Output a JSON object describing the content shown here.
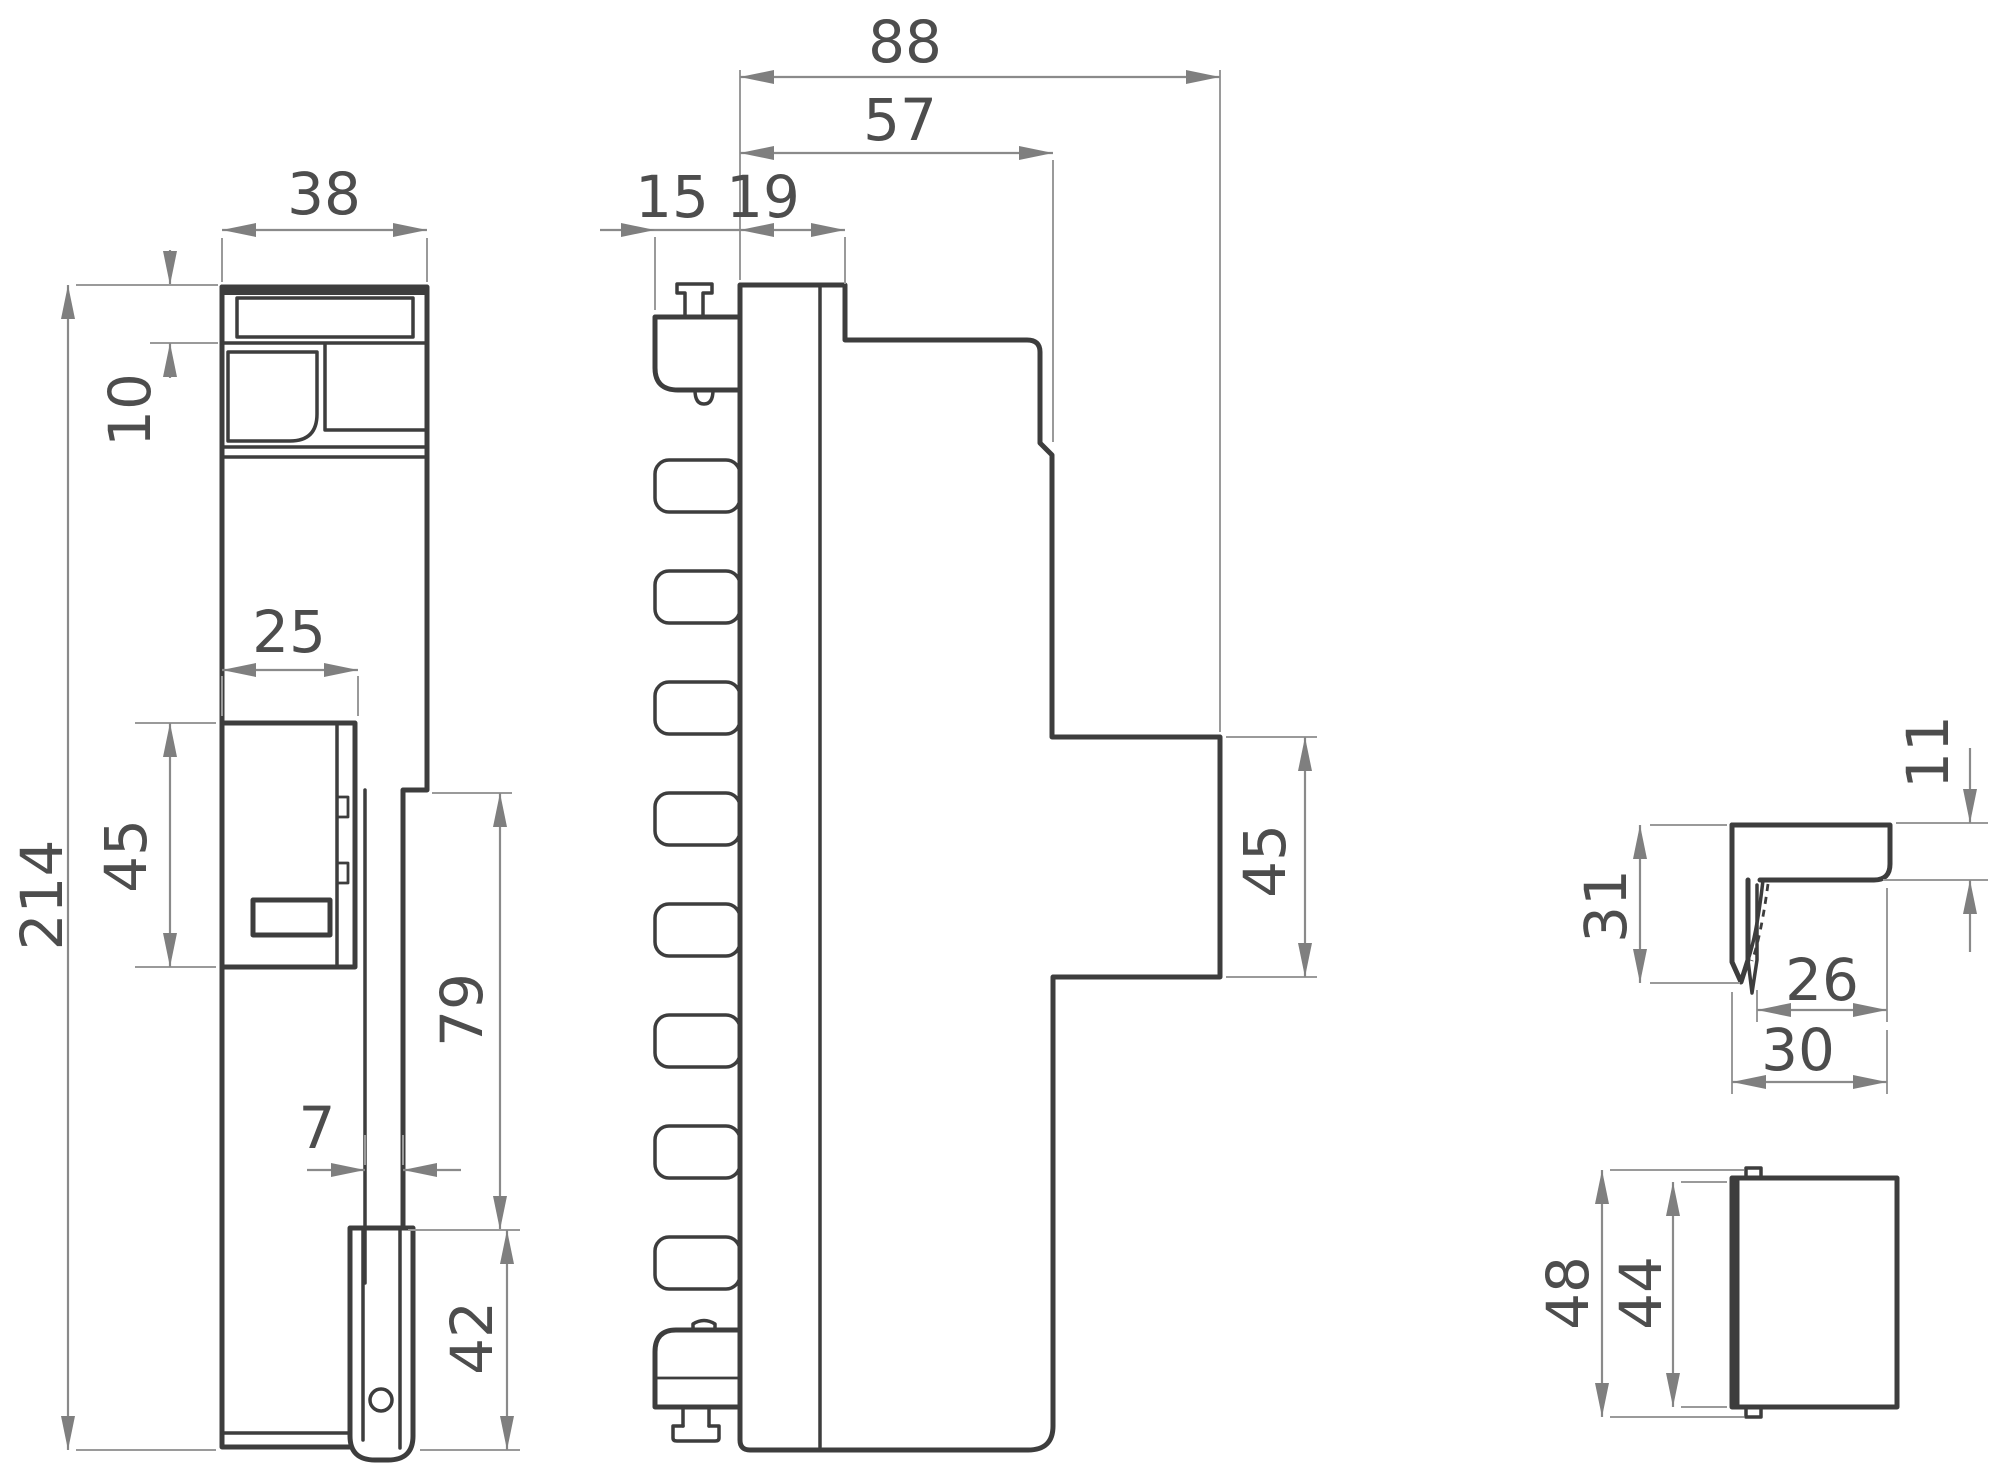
{
  "drawing_type": "technical-dimension-drawing",
  "views": {
    "front_view": "device front elevation",
    "side_view": "device side profile with fins",
    "bracket_view": "mounting bracket detail",
    "cover_view": "cover block detail"
  },
  "dims": {
    "front": {
      "overall_width": "38",
      "cap_height": "10",
      "overall_height": "214",
      "block_width": "25",
      "block_height": "45",
      "step_height": "79",
      "bar_width": "7",
      "latch_height": "42"
    },
    "side": {
      "overall_depth": "88",
      "body_depth": "57",
      "fin_depth": "15",
      "front_depth": "19",
      "tab_height": "45"
    },
    "bracket": {
      "lip_height": "11",
      "height": "31",
      "inner_width": "26",
      "width": "30"
    },
    "cover": {
      "outer_height": "48",
      "inner_height": "44"
    }
  },
  "colors": {
    "outline": "#3d3d3d",
    "dimension_line": "#8a8a8a",
    "label": "#4d4d4d",
    "background": "#ffffff"
  }
}
